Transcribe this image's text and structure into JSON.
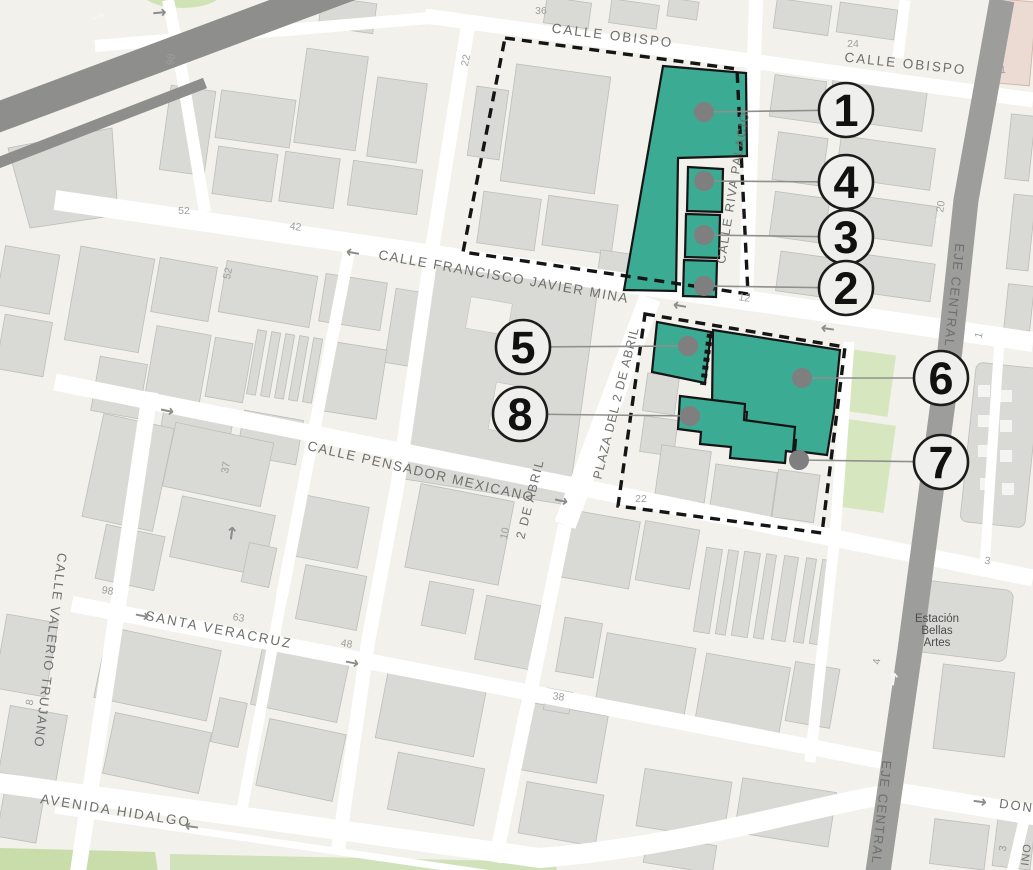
{
  "colors": {
    "background": "#f2f1ec",
    "road": "#ffffff",
    "road_major": "#9d9d9b",
    "road_diagonal": "#8e8e8c",
    "building": "#d9d9d6",
    "park": "#d6e7c0",
    "park_dark": "#c8ddaa",
    "highlight": "#3bab94",
    "boundary": "#151515",
    "pink_building": "#ecdbd2",
    "marker_fill": "#efefed",
    "marker_stroke": "#1c1c1c",
    "marker_text": "#111111",
    "dot": "#7f7f7f",
    "leader": "#8f8f8d",
    "street_text": "#6f6f6d",
    "number_text": "#9e9e9c",
    "station_text": "#4c4c4a"
  },
  "street_labels": [
    {
      "id": "calle-obispo-west",
      "text": "CALLE OBISPO",
      "x": 612,
      "y": 40,
      "rotate": 7,
      "size": 13.5,
      "spacing": 2
    },
    {
      "id": "calle-obispo-east",
      "text": "CALLE OBISPO",
      "x": 905,
      "y": 68,
      "rotate": 6,
      "size": 13.5,
      "spacing": 2
    },
    {
      "id": "calle-francisco-javier-mina",
      "text": "CALLE FRANCISCO JAVIER MINA",
      "x": 503,
      "y": 281,
      "rotate": 10,
      "size": 13.5,
      "spacing": 1.5
    },
    {
      "id": "calle-riva-palacio",
      "text": "CALLE RIVA PALACIO",
      "x": 737,
      "y": 188,
      "rotate": -81,
      "size": 12.5,
      "spacing": 1.5
    },
    {
      "id": "plaza-del-2-de-abril",
      "text": "PLAZA DEL 2 DE ABRIL",
      "x": 620,
      "y": 404,
      "rotate": -76,
      "size": 12.5,
      "spacing": 1
    },
    {
      "id": "2-de-abril",
      "text": "2 DE ABRIL",
      "x": 534,
      "y": 500,
      "rotate": -76,
      "size": 12.5,
      "spacing": 1.5
    },
    {
      "id": "calle-pensador-mexicano",
      "text": "CALLE PENSADOR MEXICANO",
      "x": 420,
      "y": 476,
      "rotate": 13,
      "size": 13.5,
      "spacing": 1.5
    },
    {
      "id": "santa-veracruz",
      "text": "SANTA VERACRUZ",
      "x": 218,
      "y": 634,
      "rotate": 11,
      "size": 13.5,
      "spacing": 2
    },
    {
      "id": "calle-valerio-trujano",
      "text": "CALLE VALERIO TRUJANO",
      "x": 46,
      "y": 650,
      "rotate": 97,
      "size": 13,
      "spacing": 1.5
    },
    {
      "id": "avenida-hidalgo",
      "text": "AVENIDA HIDALGO",
      "x": 115,
      "y": 815,
      "rotate": 9,
      "size": 13.5,
      "spacing": 2
    },
    {
      "id": "eje-central-north",
      "text": "EJE CENTRAL",
      "x": 950,
      "y": 295,
      "rotate": 96,
      "size": 13,
      "spacing": 1.5
    },
    {
      "id": "eje-central-south",
      "text": "EJE CENTRAL",
      "x": 877,
      "y": 812,
      "rotate": 96,
      "size": 13,
      "spacing": 1.5
    },
    {
      "id": "don-street",
      "text": "DON",
      "x": 1016,
      "y": 810,
      "rotate": 8,
      "size": 13,
      "spacing": 2
    },
    {
      "id": "oni-street",
      "text": "ONI",
      "x": 1022,
      "y": 855,
      "rotate": 97,
      "size": 11,
      "spacing": 1
    }
  ],
  "station_label": {
    "lines": [
      "Estación",
      "Bellas",
      "Artes"
    ],
    "x": 937,
    "y": 622,
    "line_height": 12
  },
  "house_numbers": [
    {
      "text": "36",
      "x": 541,
      "y": 14,
      "rotate": 0
    },
    {
      "text": "22",
      "x": 469,
      "y": 61,
      "rotate": -78
    },
    {
      "text": "24",
      "x": 853,
      "y": 47,
      "rotate": 0
    },
    {
      "text": "1",
      "x": 1003,
      "y": 73,
      "rotate": 0
    },
    {
      "text": "20",
      "x": 944,
      "y": 207,
      "rotate": -82
    },
    {
      "text": "98",
      "x": 174,
      "y": 60,
      "rotate": -80
    },
    {
      "text": "52",
      "x": 184,
      "y": 214,
      "rotate": 0
    },
    {
      "text": "42",
      "x": 295,
      "y": 230,
      "rotate": 8
    },
    {
      "text": "52",
      "x": 231,
      "y": 274,
      "rotate": -78
    },
    {
      "text": "12",
      "x": 744,
      "y": 301,
      "rotate": 8
    },
    {
      "text": "12",
      "x": 852,
      "y": 314,
      "rotate": 8
    },
    {
      "text": "37",
      "x": 229,
      "y": 468,
      "rotate": -80
    },
    {
      "text": "22",
      "x": 641,
      "y": 502,
      "rotate": 0
    },
    {
      "text": "10",
      "x": 508,
      "y": 534,
      "rotate": -78
    },
    {
      "text": "98",
      "x": 107,
      "y": 594,
      "rotate": 10
    },
    {
      "text": "63",
      "x": 238,
      "y": 621,
      "rotate": 10
    },
    {
      "text": "48",
      "x": 346,
      "y": 647,
      "rotate": 10
    },
    {
      "text": "38",
      "x": 558,
      "y": 700,
      "rotate": 8
    },
    {
      "text": "3",
      "x": 987,
      "y": 564,
      "rotate": 8
    },
    {
      "text": "4",
      "x": 880,
      "y": 662,
      "rotate": -82
    },
    {
      "text": "3",
      "x": 1006,
      "y": 849,
      "rotate": -80
    },
    {
      "text": "1",
      "x": 982,
      "y": 336,
      "rotate": -75
    },
    {
      "text": "8",
      "x": 33,
      "y": 703,
      "rotate": -78
    }
  ],
  "arrows": [
    {
      "glyph": "→",
      "x": 160,
      "y": 18,
      "rotate": -5,
      "color": "#8c8c8a"
    },
    {
      "glyph": "→",
      "x": 100,
      "y": 22,
      "rotate": -21,
      "color": "#f5f5f3"
    },
    {
      "glyph": "←",
      "x": 352,
      "y": 258,
      "rotate": 10,
      "color": "#8c8c8a"
    },
    {
      "glyph": "←",
      "x": 679,
      "y": 311,
      "rotate": 10,
      "color": "#8c8c8a"
    },
    {
      "glyph": "←",
      "x": 827,
      "y": 334,
      "rotate": 8,
      "color": "#8c8c8a"
    },
    {
      "glyph": "→",
      "x": 166,
      "y": 416,
      "rotate": 12,
      "color": "#8c8c8a"
    },
    {
      "glyph": "→",
      "x": 560,
      "y": 506,
      "rotate": 12,
      "color": "#8c8c8a"
    },
    {
      "glyph": "→",
      "x": 237,
      "y": 534,
      "rotate": -82,
      "color": "#8c8c8a"
    },
    {
      "glyph": "→",
      "x": 141,
      "y": 621,
      "rotate": 11,
      "color": "#8c8c8a"
    },
    {
      "glyph": "→",
      "x": 351,
      "y": 668,
      "rotate": 11,
      "color": "#8c8c8a"
    },
    {
      "glyph": "←",
      "x": 191,
      "y": 832,
      "rotate": 8,
      "color": "#8c8c8a"
    },
    {
      "glyph": "→",
      "x": 944,
      "y": 224,
      "rotate": -82,
      "color": "#f5f5f3"
    },
    {
      "glyph": "→",
      "x": 899,
      "y": 680,
      "rotate": -82,
      "color": "#f5f5f3"
    },
    {
      "glyph": "→",
      "x": 979,
      "y": 807,
      "rotate": 8,
      "color": "#8c8c8a"
    }
  ],
  "markers": [
    {
      "label": "1",
      "cx": 846,
      "cy": 110,
      "dot_x": 704,
      "dot_y": 112
    },
    {
      "label": "4",
      "cx": 846,
      "cy": 182,
      "dot_x": 704,
      "dot_y": 181
    },
    {
      "label": "3",
      "cx": 846,
      "cy": 237,
      "dot_x": 704,
      "dot_y": 235
    },
    {
      "label": "2",
      "cx": 846,
      "cy": 288,
      "dot_x": 704,
      "dot_y": 286
    },
    {
      "label": "5",
      "cx": 523,
      "cy": 347,
      "dot_x": 688,
      "dot_y": 346
    },
    {
      "label": "8",
      "cx": 520,
      "cy": 414,
      "dot_x": 690,
      "dot_y": 416
    },
    {
      "label": "6",
      "cx": 941,
      "cy": 378,
      "dot_x": 802,
      "dot_y": 378
    },
    {
      "label": "7",
      "cx": 941,
      "cy": 462,
      "dot_x": 799,
      "dot_y": 460
    }
  ]
}
